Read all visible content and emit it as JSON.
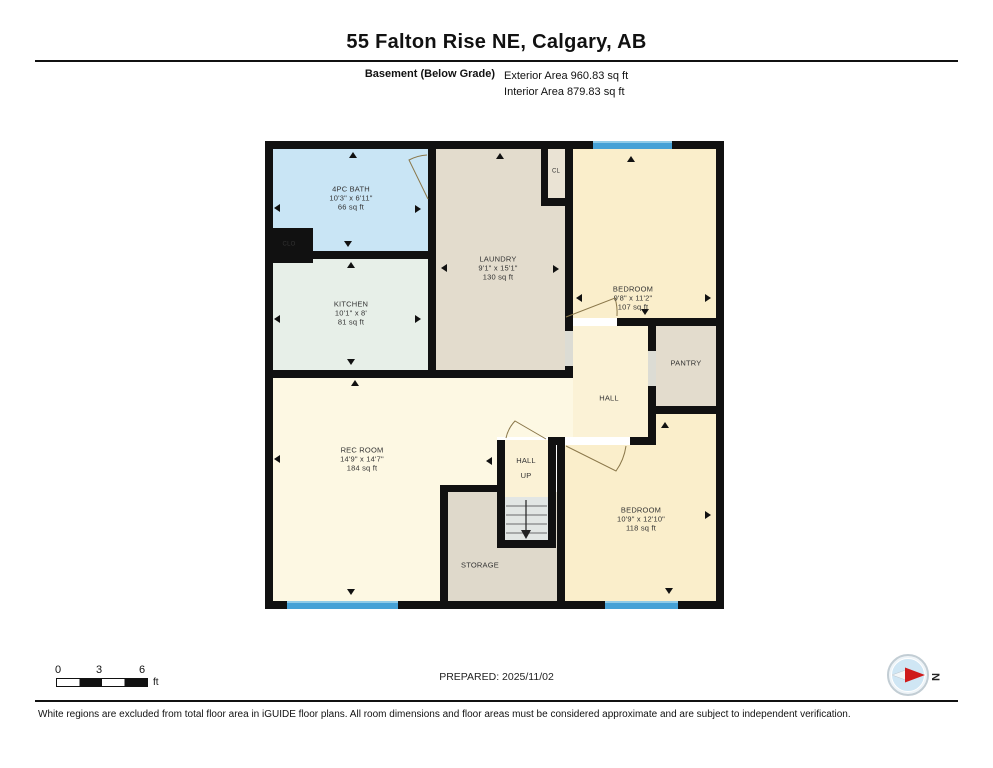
{
  "header": {
    "title": "55 Falton Rise NE, Calgary, AB",
    "floor_label": "Basement (Below Grade)",
    "exterior_area": "Exterior Area 960.83 sq ft",
    "interior_area": "Interior Area 879.83 sq ft"
  },
  "rooms": {
    "bath": {
      "name": "4PC BATH",
      "dims": "10'3\" x 6'11\"",
      "area": "66 sq ft"
    },
    "kitchen": {
      "name": "KITCHEN",
      "dims": "10'1\" x 8'",
      "area": "81 sq ft"
    },
    "laundry": {
      "name": "LAUNDRY",
      "dims": "9'1\" x 15'1\"",
      "area": "130 sq ft"
    },
    "bedroom1": {
      "name": "BEDROOM",
      "dims": "9'8\" x 11'2\"",
      "area": "107 sq ft"
    },
    "recroom": {
      "name": "REC ROOM",
      "dims": "14'9\" x 14'7\"",
      "area": "184 sq ft"
    },
    "bedroom2": {
      "name": "BEDROOM",
      "dims": "10'9\" x 12'10\"",
      "area": "118 sq ft"
    },
    "pantry": {
      "name": "PANTRY"
    },
    "hall": {
      "name": "HALL"
    },
    "hall_up": {
      "name": "HALL",
      "name2": "UP"
    },
    "storage": {
      "name": "STORAGE"
    },
    "cl": {
      "name": "CL"
    },
    "clo": {
      "name": "CLO"
    }
  },
  "scale_bar": {
    "tick0": "0",
    "tick1": "3",
    "tick2": "6",
    "unit": "ft"
  },
  "footer": {
    "prepared": "PREPARED: 2025/11/02",
    "disclaimer": "White regions are excluded from total floor area in iGUIDE floor plans. All room dimensions and floor areas must be considered approximate and are subject to independent verification."
  },
  "compass": {
    "north_label": "N"
  },
  "colors": {
    "wall": "#111111",
    "bath": "#c9e5f5",
    "kitchen": "#e7efe8",
    "laundry_pantry_storage": "#e3dccd",
    "bedroom": "#faeecb",
    "rec_hall": "#fdf8e3",
    "window": "#45a1d6",
    "stairs": "#e2e6e4",
    "compass_arrow": "#cf1b1b"
  }
}
